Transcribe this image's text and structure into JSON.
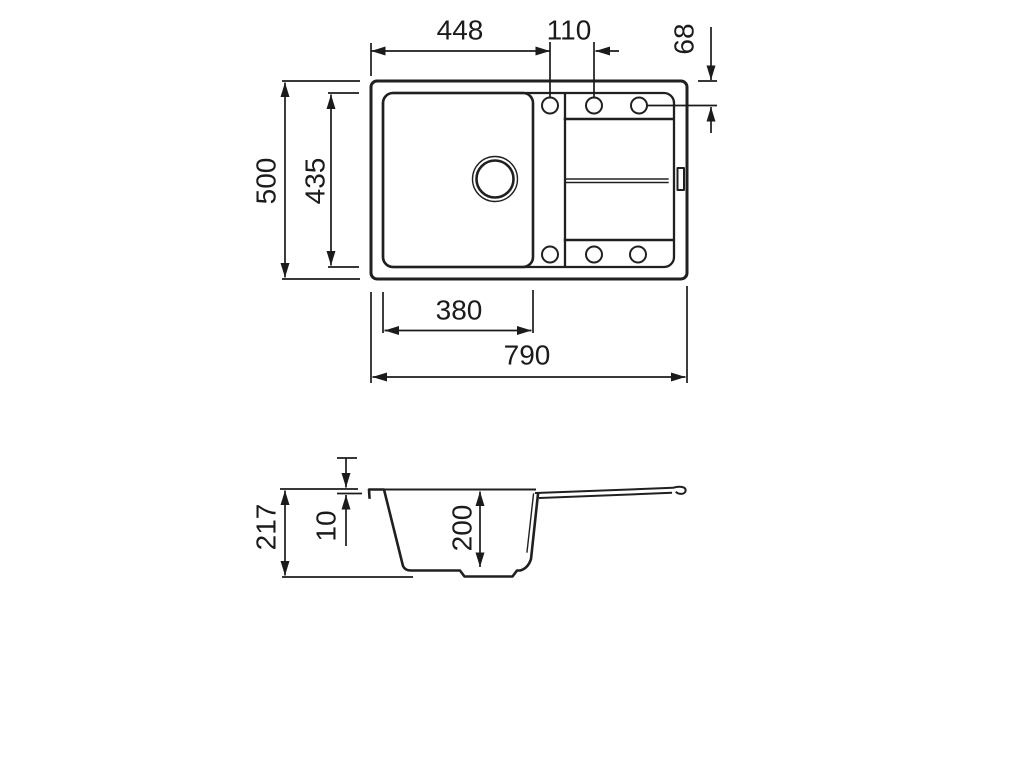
{
  "drawing": {
    "type": "technical-dimension-drawing",
    "subject": "kitchen sink with drainboard, top view and side section view",
    "colors": {
      "line": "#202020",
      "dimension": "#1b1b1b",
      "background": "#ffffff"
    },
    "dimensions": {
      "top_view": {
        "left_edge_to_first_hole": "448",
        "hole_spacing": "110",
        "hole_offset_from_edge": "68",
        "overall_depth": "500",
        "inner_depth": "435",
        "bowl_width": "380",
        "overall_width": "790"
      },
      "side_view": {
        "overall_height": "217",
        "rim_height": "10",
        "bowl_depth": "200"
      }
    }
  }
}
